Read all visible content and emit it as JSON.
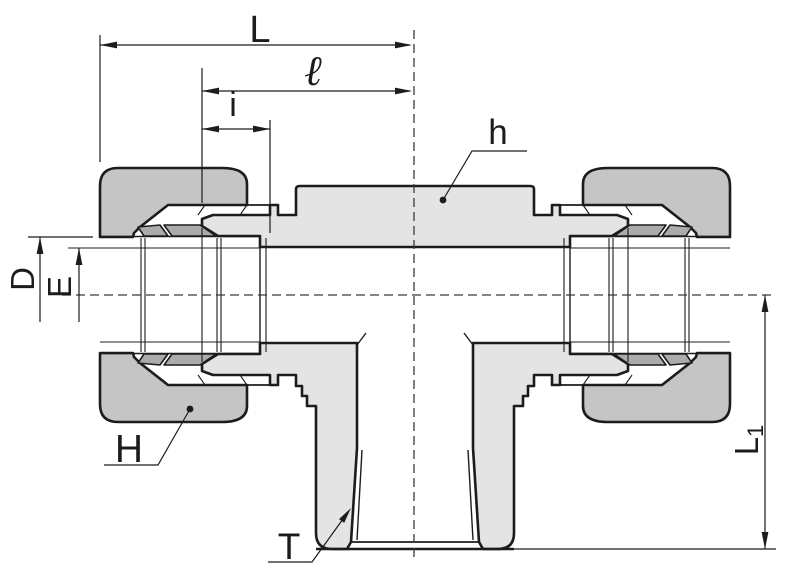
{
  "drawing": {
    "description": "Cross-section dimensional drawing of a compression branch tee tube fitting",
    "labels": {
      "L": "L",
      "ell": "ℓ",
      "i": "i",
      "h": "h",
      "D": "D",
      "E": "E",
      "H": "H",
      "T": "T",
      "L1": {
        "base": "L",
        "sub": "1"
      }
    }
  },
  "colors": {
    "c-nut": "#c5c5c5",
    "c-body": "#e4e4e4",
    "c-ferrule": "#ababab",
    "c-line": "#1c1c1c",
    "c-bg": "#ffffff"
  }
}
